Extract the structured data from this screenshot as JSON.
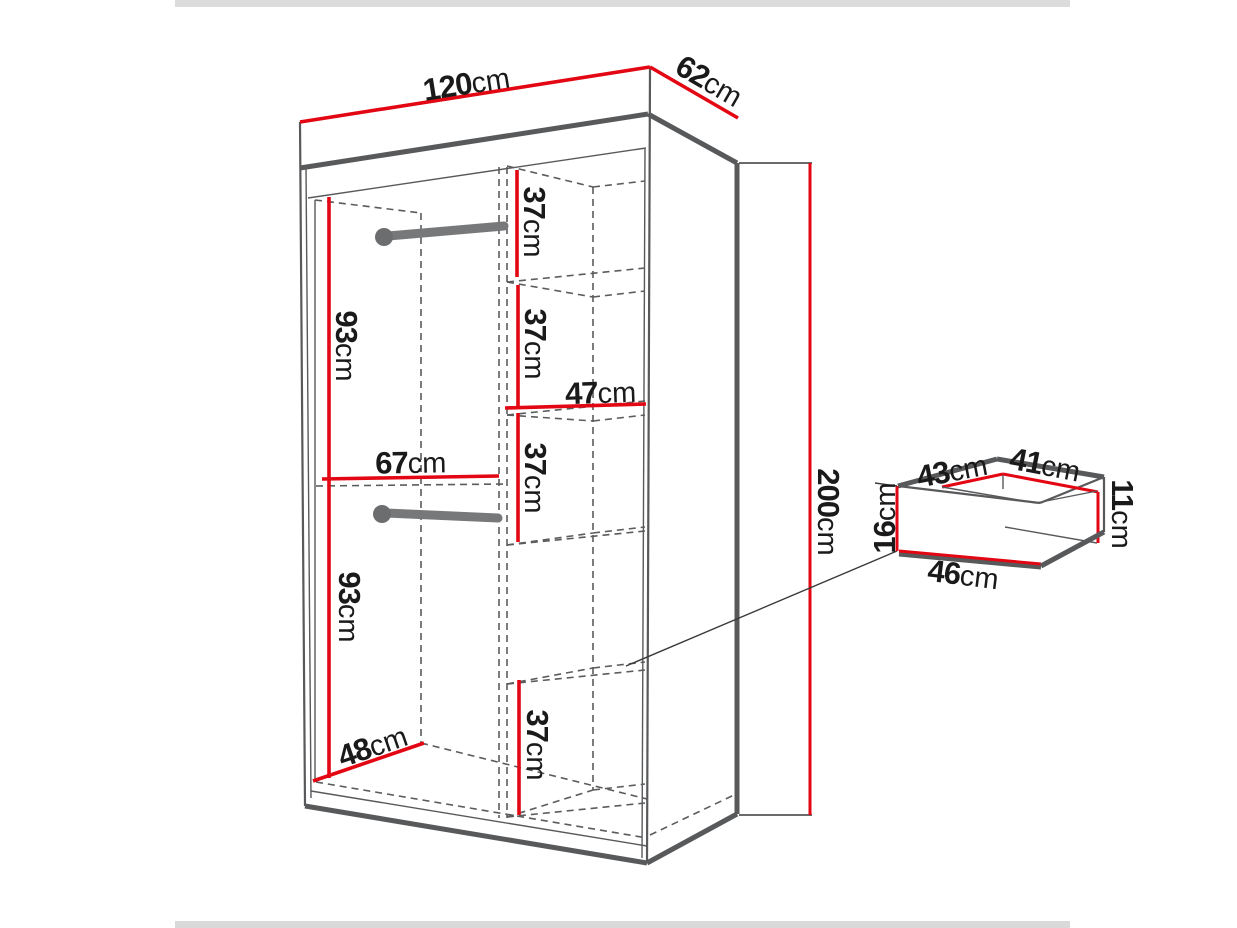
{
  "colors": {
    "dimension_line": "#e30613",
    "structure_line": "#58595b",
    "label_text": "#1a1a1a"
  },
  "wardrobe": {
    "width": {
      "value": "120",
      "unit": "cm"
    },
    "depth": {
      "value": "62",
      "unit": "cm"
    },
    "height": {
      "value": "200",
      "unit": "cm"
    },
    "left_section": {
      "upper_hanging_height": {
        "value": "93",
        "unit": "cm"
      },
      "lower_hanging_height": {
        "value": "93",
        "unit": "cm"
      },
      "interior_width": {
        "value": "67",
        "unit": "cm"
      },
      "interior_depth": {
        "value": "48",
        "unit": "cm"
      }
    },
    "right_section": {
      "shelf_width": {
        "value": "47",
        "unit": "cm"
      },
      "compartment_heights": [
        {
          "value": "37",
          "unit": "cm"
        },
        {
          "value": "37",
          "unit": "cm"
        },
        {
          "value": "37",
          "unit": "cm"
        },
        {
          "value": "37",
          "unit": "cm"
        }
      ]
    }
  },
  "drawer": {
    "top_width": {
      "value": "43",
      "unit": "cm"
    },
    "top_depth": {
      "value": "41",
      "unit": "cm"
    },
    "front_height": {
      "value": "16",
      "unit": "cm"
    },
    "side_height": {
      "value": "11",
      "unit": "cm"
    },
    "bottom_width": {
      "value": "46",
      "unit": "cm"
    }
  }
}
